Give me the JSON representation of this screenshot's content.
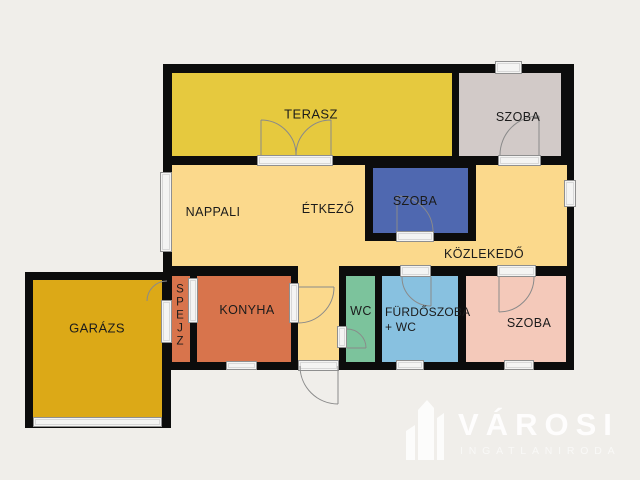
{
  "page": {
    "background": "#f0eeea"
  },
  "plan": {
    "wall_color": "#0c0c0c",
    "rooms": {
      "terasz": {
        "label": "TERASZ",
        "color": "#e6c93e"
      },
      "szoba_top": {
        "label": "SZOBA",
        "color": "#d2cac8"
      },
      "nappali": {
        "label": "NAPPALI",
        "color": "#fbd98c"
      },
      "etkezo": {
        "label": "ÉTKEZŐ"
      },
      "szoba_middle": {
        "label": "SZOBA",
        "color": "#4f68b0"
      },
      "kozlekedo": {
        "label": "KÖZLEKEDŐ"
      },
      "garazs": {
        "label": "GARÁZS",
        "color": "#dca917"
      },
      "spejz": {
        "label": "SPEJZ",
        "color": "#d8744c"
      },
      "konyha": {
        "label": "KONYHA",
        "color": "#d8744c"
      },
      "wc": {
        "label": "WC",
        "color": "#7cc39c"
      },
      "furdoszoba": {
        "label": "FÜRDŐSZOBA",
        "label_line2": "+ WC",
        "color": "#88c1e0"
      },
      "szoba_bottom": {
        "label": "SZOBA",
        "color": "#f4c9ba"
      }
    }
  },
  "watermark": {
    "brand": "VÁROSI",
    "subtitle": "INGATLANIRODA"
  }
}
